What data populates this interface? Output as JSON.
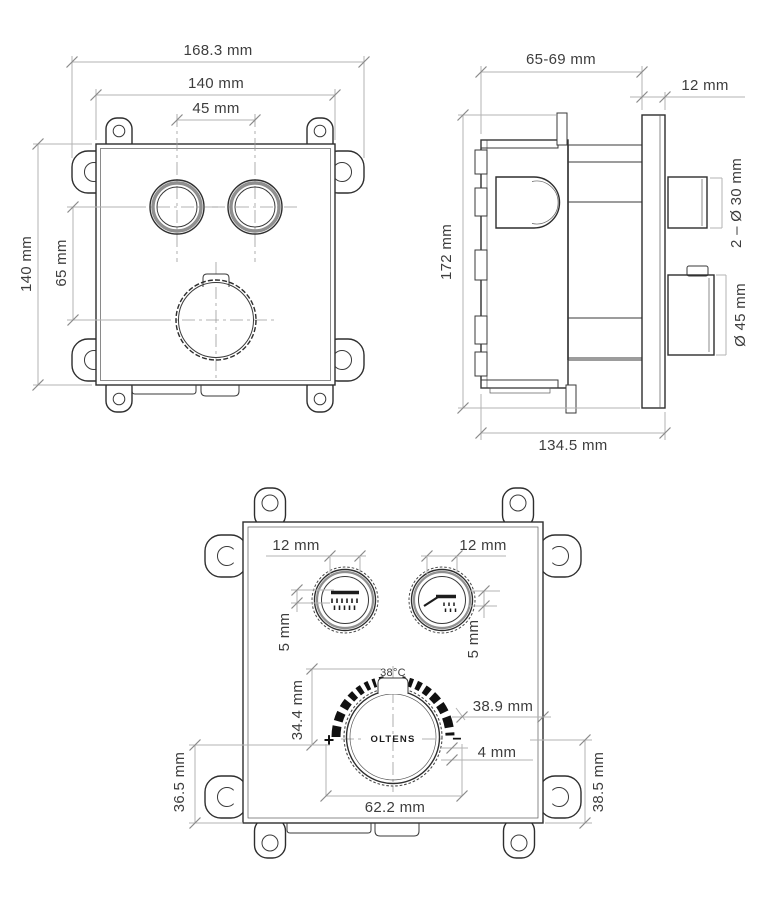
{
  "drawing": {
    "brand": "OLTENS",
    "views": {
      "front_rough": {
        "dims": {
          "overall_width": "168.3 mm",
          "body_width": "140 mm",
          "handle_spacing": "45 mm",
          "body_height": "140 mm",
          "handle_to_dial": "65 mm"
        }
      },
      "side": {
        "dims": {
          "install_depth_range": "65-69 mm",
          "plate_thickness": "12 mm",
          "height": "172 mm",
          "small_handles": "2 – Ø 30 mm",
          "dial_diameter": "Ø 45 mm",
          "total_depth": "134.5 mm"
        }
      },
      "front_trim": {
        "dims": {
          "left_handle_marker": "12 mm",
          "right_handle_marker": "12 mm",
          "left_ring": "5 mm",
          "right_ring": "5 mm",
          "temp_setpoint": "38°C",
          "arc_height": "34.4 mm",
          "arc_to_edge": "38.9 mm",
          "marker_gap": "4 mm",
          "plus": "+",
          "minus": "−",
          "dial_width": "62.2 mm",
          "dial_to_bottom_left": "36.5 mm",
          "dial_to_bottom_right": "38.5 mm"
        }
      }
    }
  }
}
